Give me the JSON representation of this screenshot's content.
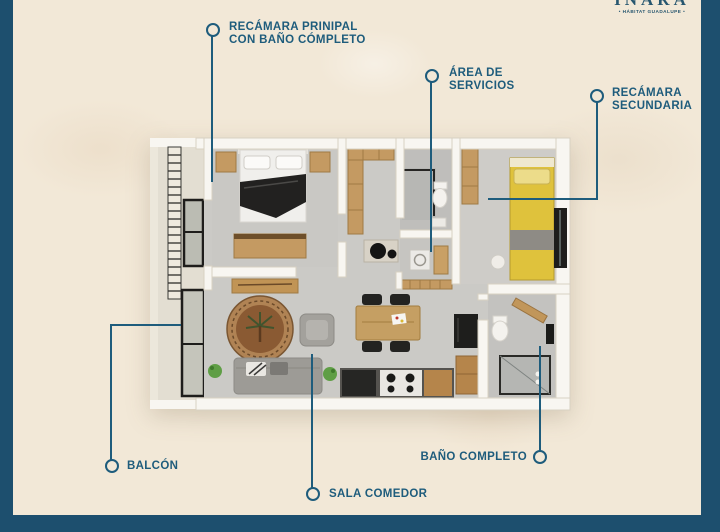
{
  "page": {
    "paper_color": "#f2e8d7",
    "frame_color": "#1d4f6e",
    "accent_color": "#1e5c7c"
  },
  "logo": {
    "brand": "INARA",
    "tagline": "• HÁBITAT GUADALUPE •"
  },
  "labels": {
    "recamara_principal": {
      "line1": "RECÁMARA PRINIPAL",
      "line2": "CON BAÑO CÓMPLETO"
    },
    "area_servicios": {
      "line1": "ÁREA DE",
      "line2": "SERVICIOS"
    },
    "recamara_secundaria": {
      "line1": "RECÁMARA",
      "line2": "SECUNDARIA"
    },
    "balcon": {
      "text": "BALCÓN"
    },
    "sala_comedor": {
      "text": "SALA COMEDOR"
    },
    "bano_completo": {
      "text": "BAÑO COMPLETO"
    }
  },
  "floorplan_palette": {
    "wall": "#f8f6f1",
    "floor": "#cbcac6",
    "wood": "#c49a62",
    "bed_yellow": "#dfc23c",
    "dark_furniture": "#232321"
  }
}
